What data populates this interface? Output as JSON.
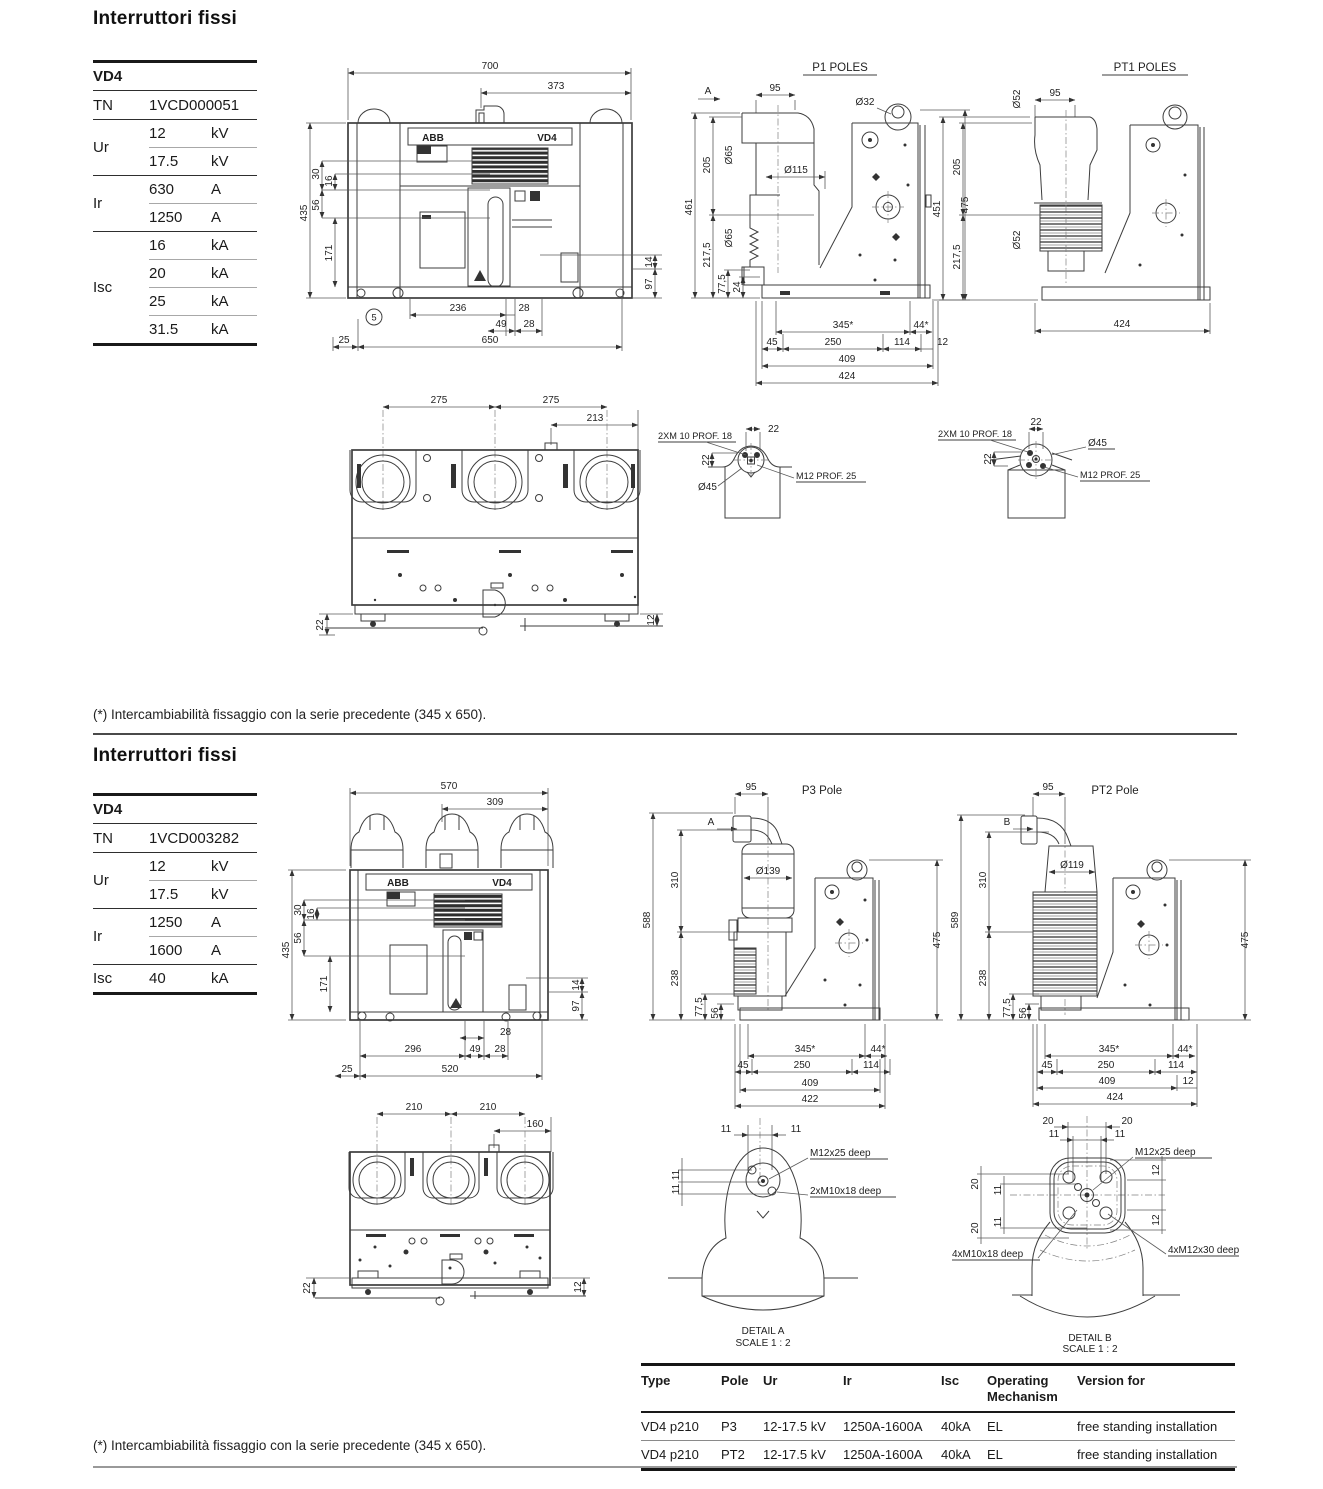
{
  "s1": {
    "heading": "Interruttori fissi",
    "spec": {
      "title": "VD4",
      "rows": [
        {
          "label": "TN",
          "value": "1VCD000051",
          "unit": ""
        },
        {
          "label": "Ur",
          "value": "12",
          "unit": "kV"
        },
        {
          "label": "",
          "value": "17.5",
          "unit": "kV"
        },
        {
          "label": "Ir",
          "value": "630",
          "unit": "A"
        },
        {
          "label": "",
          "value": "1250",
          "unit": "A"
        },
        {
          "label": "Isc",
          "value": "16",
          "unit": "kA"
        },
        {
          "label": "",
          "value": "20",
          "unit": "kA"
        },
        {
          "label": "",
          "value": "25",
          "unit": "kA"
        },
        {
          "label": "",
          "value": "31.5",
          "unit": "kA"
        }
      ]
    },
    "front": {
      "brand": "ABB",
      "model": "VD4",
      "callout": "5",
      "dims": {
        "total_w": "700",
        "inner_w": "373",
        "h": "435",
        "o30": "30",
        "o16": "16",
        "o56": "56",
        "o171": "171",
        "o14": "14",
        "o97": "97",
        "b236": "236",
        "b28a": "28",
        "b49": "49",
        "b28b": "28",
        "b25": "25",
        "b650": "650"
      }
    },
    "p1": {
      "title": "P1 POLES",
      "view_arrow": "A",
      "dims": {
        "t95": "95",
        "dia32": "Ø32",
        "dia65a": "Ø65",
        "l205": "205",
        "dia115": "Ø115",
        "l461": "461",
        "dia65b": "Ø65",
        "l2175": "217,5",
        "l775": "77,5",
        "l24": "24",
        "r475": "475",
        "b345": "345*",
        "b44": "44*",
        "b45": "45",
        "b250": "250",
        "b114": "114",
        "b12": "12",
        "b409": "409",
        "b424": "424"
      }
    },
    "pt1": {
      "title": "PT1 POLES",
      "dims": {
        "dia52a": "Ø52",
        "t95": "95",
        "l205": "205",
        "l451": "451",
        "dia52b": "Ø52",
        "l2175": "217,5",
        "b424": "424"
      }
    },
    "top": {
      "dims": {
        "t275a": "275",
        "t275b": "275",
        "t213": "213",
        "r12": "12",
        "l22": "22"
      }
    },
    "detail_left": {
      "bolt_label": "2XM 10 PROF. 18",
      "t22": "22",
      "l22": "22",
      "dia45": "Ø45",
      "thread_label": "M12 PROF. 25"
    },
    "detail_right": {
      "bolt_label": "2XM 10 PROF. 18",
      "t22": "22",
      "l22": "22",
      "dia45": "Ø45",
      "thread_label": "M12 PROF. 25"
    },
    "note": "(*) Intercambiabilità fissaggio con la serie precedente (345 x 650)."
  },
  "s2": {
    "heading": "Interruttori fissi",
    "spec": {
      "title": "VD4",
      "rows": [
        {
          "label": "TN",
          "value": "1VCD003282",
          "unit": ""
        },
        {
          "label": "Ur",
          "value": "12",
          "unit": "kV"
        },
        {
          "label": "",
          "value": "17.5",
          "unit": "kV"
        },
        {
          "label": "Ir",
          "value": "1250",
          "unit": "A"
        },
        {
          "label": "",
          "value": "1600",
          "unit": "A"
        },
        {
          "label": "Isc",
          "value": "40",
          "unit": "kA"
        }
      ]
    },
    "front": {
      "brand": "ABB",
      "model": "VD4",
      "dims": {
        "total_w": "570",
        "inner_w": "309",
        "h": "435",
        "o30": "30",
        "o16": "16",
        "o56": "56",
        "o171": "171",
        "o14": "14",
        "o97": "97",
        "b28a": "28",
        "b296": "296",
        "b49": "49",
        "b28b": "28",
        "b25": "25",
        "b520": "520"
      }
    },
    "p3": {
      "title": "P3 Pole",
      "view_arrow": "A",
      "dims": {
        "t95": "95",
        "l310": "310",
        "dia139": "Ø139",
        "l588": "588",
        "l238": "238",
        "l775": "77,5",
        "l56": "56",
        "r475": "475",
        "b345": "345*",
        "b44": "44*",
        "b45": "45",
        "b250": "250",
        "b114": "114",
        "b409": "409",
        "b422": "422"
      }
    },
    "pt2": {
      "title": "PT2 Pole",
      "view_arrow": "B",
      "dims": {
        "t95": "95",
        "l310": "310",
        "dia119": "Ø119",
        "l589": "589",
        "l238": "238",
        "l775": "77,5",
        "l56": "56",
        "r475": "475",
        "b345": "345*",
        "b44": "44*",
        "b45": "45",
        "b250": "250",
        "b114": "114",
        "b409": "409",
        "b12": "12",
        "b424": "424"
      }
    },
    "top": {
      "dims": {
        "t210a": "210",
        "t210b": "210",
        "t160": "160",
        "l22": "22",
        "r12": "12"
      }
    },
    "detail_a": {
      "d11a": "11",
      "d11b": "11",
      "d11c": "11",
      "d11d": "11",
      "label1": "M12x25 deep",
      "label2": "2xM10x18 deep",
      "caption": "DETAIL A",
      "scale": "SCALE 1 : 2"
    },
    "detail_b": {
      "d20a": "20",
      "d20b": "20",
      "d11a": "11",
      "d11b": "11",
      "d20c": "20",
      "d11c": "11",
      "d20d": "20",
      "d11d": "11",
      "d12a": "12",
      "d12b": "12",
      "label1": "M12x25 deep",
      "label2": "4xM10x18 deep",
      "label3": "4xM12x30 deep",
      "caption": "DETAIL B",
      "scale": "SCALE 1 : 2"
    },
    "note": "(*) Intercambiabilità fissaggio con la serie precedente (345 x 650)."
  },
  "types_table": {
    "headers": [
      "Type",
      "Pole",
      "Ur",
      "Ir",
      "Isc",
      "Operating Mechanism",
      "Version for"
    ],
    "rows": [
      [
        "VD4 p210",
        "P3",
        "12-17.5 kV",
        "1250A-1600A",
        "40kA",
        "EL",
        "free standing installation"
      ],
      [
        "VD4 p210",
        "PT2",
        "12-17.5 kV",
        "1250A-1600A",
        "40kA",
        "EL",
        "free standing installation"
      ]
    ]
  }
}
